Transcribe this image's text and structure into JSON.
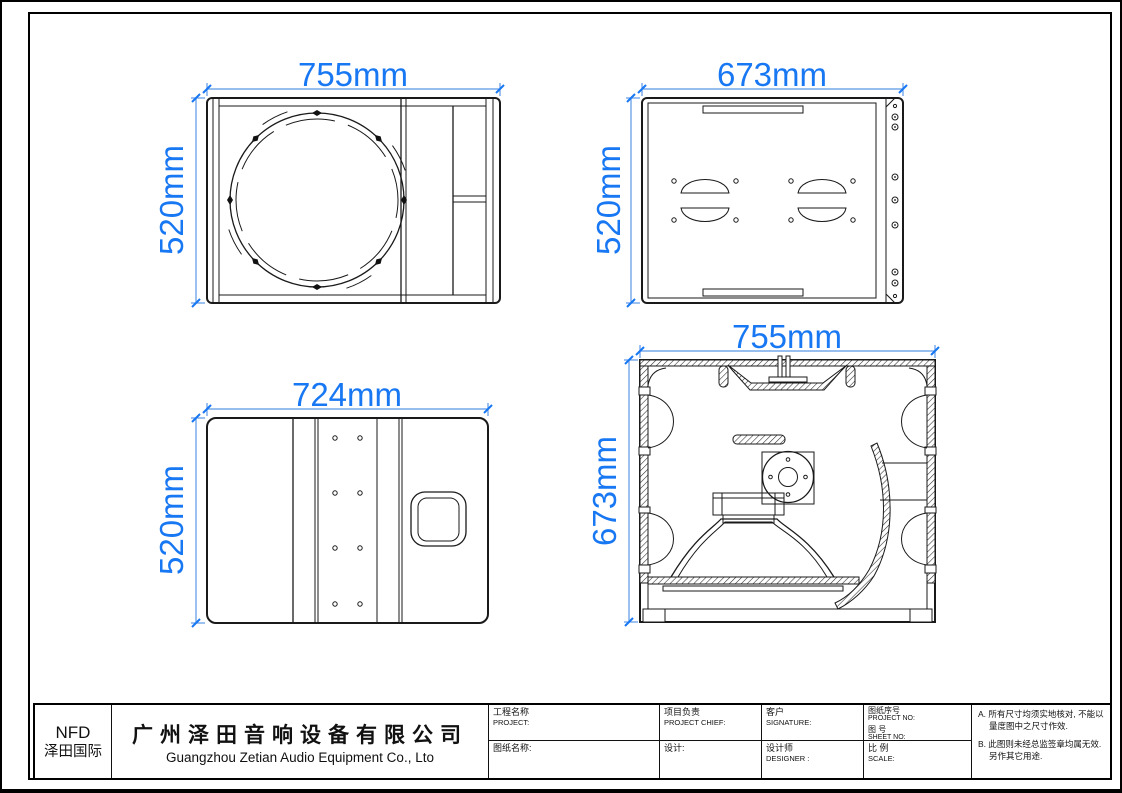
{
  "colors": {
    "dimension_text": "#1877f2",
    "dimension_line": "#5b97e6",
    "drawing_line": "#1a1a1a",
    "background": "#ffffff"
  },
  "views": {
    "front": {
      "width": "755mm",
      "height": "520mm"
    },
    "rear": {
      "width": "673mm",
      "height": "520mm"
    },
    "side": {
      "width": "724mm",
      "height": "520mm"
    },
    "section": {
      "width": "755mm",
      "height": "673mm"
    }
  },
  "title_block": {
    "brand_code": "NFD",
    "brand_name": "泽田国际",
    "company_cn": "广州泽田音响设备有限公司",
    "company_en": "Guangzhou Zetian Audio Equipment Co., Lto",
    "fields": {
      "project_cn": "工程名称",
      "project_en": "PROJECT:",
      "chief_cn": "项目负责",
      "chief_en": "PROJECT CHIEF:",
      "customer_cn": "客户",
      "customer_en": "SIGNATURE:",
      "drawing_no_cn": "图纸序号",
      "drawing_no_en": "PROJECT NO:",
      "sheet_no_cn": "图 号",
      "sheet_no_en": "SHEET NO:",
      "scale_cn": "比 例",
      "scale_en": "SCALE:",
      "drawing_name_cn": "图纸名称:",
      "design_cn": "设计:",
      "designer_cn": "设计师",
      "designer_en": "DESIGNER :"
    },
    "notes": {
      "a": "A. 所有尺寸均须实地核对, 不能以量度图中之尺寸作效.",
      "b": "B. 此图则未经总监签章均属无效. 另作其它用途."
    }
  }
}
